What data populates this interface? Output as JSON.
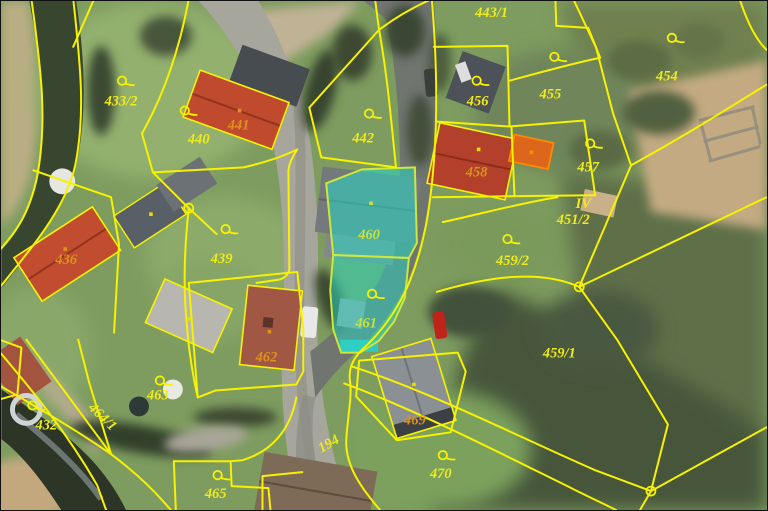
{
  "map": {
    "type": "cadastral-aerial-map",
    "highlighted_parcels": [
      "460",
      "461"
    ],
    "selected_building_parcel": "458-annex",
    "colors": {
      "parcel_line": "#f6f200",
      "land_label": "#f0eb1c",
      "building_label": "#dd921c",
      "highlight_label": "#c9e23a",
      "highlight_fill": "rgba(38,216,196,0.55)",
      "highlight_border": "#cfe63a",
      "selected_fill": "rgba(255,125,0,0.5)",
      "selected_border": "#ff8800"
    },
    "parcels": [
      {
        "number": "433/2",
        "kind": "land",
        "x": 120,
        "y": 100,
        "icon": {
          "x": 121,
          "y": 80
        }
      },
      {
        "number": "440",
        "kind": "land",
        "x": 198,
        "y": 138,
        "icon": {
          "x": 184,
          "y": 110
        }
      },
      {
        "number": "441",
        "kind": "building",
        "x": 238,
        "y": 124
      },
      {
        "number": "442",
        "kind": "land",
        "x": 363,
        "y": 137,
        "icon": {
          "x": 369,
          "y": 113
        }
      },
      {
        "number": "443/1",
        "kind": "land",
        "x": 492,
        "y": 11
      },
      {
        "number": "456",
        "kind": "land",
        "x": 478,
        "y": 100,
        "icon": {
          "x": 477,
          "y": 80
        }
      },
      {
        "number": "455",
        "kind": "land",
        "x": 551,
        "y": 93,
        "icon": {
          "x": 555,
          "y": 56
        }
      },
      {
        "number": "454",
        "kind": "land",
        "x": 668,
        "y": 75,
        "icon": {
          "x": 673,
          "y": 37
        }
      },
      {
        "number": "457",
        "kind": "land",
        "x": 589,
        "y": 166,
        "icon": {
          "x": 591,
          "y": 143
        }
      },
      {
        "number": "458",
        "kind": "building",
        "x": 477,
        "y": 171
      },
      {
        "number": "IV",
        "kind": "land",
        "x": 584,
        "y": 203
      },
      {
        "number": "451/2",
        "kind": "land",
        "x": 574,
        "y": 219
      },
      {
        "number": "459/2",
        "kind": "land",
        "x": 513,
        "y": 260,
        "icon": {
          "x": 508,
          "y": 239
        }
      },
      {
        "number": "459/1",
        "kind": "land",
        "x": 560,
        "y": 353
      },
      {
        "number": "436",
        "kind": "building",
        "x": 65,
        "y": 259
      },
      {
        "number": "439",
        "kind": "land",
        "x": 221,
        "y": 258,
        "icon": {
          "x": 225,
          "y": 229
        }
      },
      {
        "number": "460",
        "kind": "highlight",
        "x": 369,
        "y": 234
      },
      {
        "number": "461",
        "kind": "highlight",
        "x": 366,
        "y": 323,
        "icon": {
          "x": 372,
          "y": 294
        }
      },
      {
        "number": "462",
        "kind": "building",
        "x": 266,
        "y": 357
      },
      {
        "number": "432",
        "kind": "land",
        "x": 45,
        "y": 425,
        "icon": {
          "x": 31,
          "y": 406
        }
      },
      {
        "number": "464/1",
        "kind": "land",
        "x": 102,
        "y": 417,
        "rot": 44
      },
      {
        "number": "463",
        "kind": "land",
        "x": 157,
        "y": 395,
        "icon": {
          "x": 159,
          "y": 381
        }
      },
      {
        "number": "465",
        "kind": "land",
        "x": 215,
        "y": 494,
        "icon": {
          "x": 217,
          "y": 476
        }
      },
      {
        "number": "194",
        "kind": "land",
        "x": 328,
        "y": 444,
        "rot": -30
      },
      {
        "number": "469",
        "kind": "building",
        "x": 415,
        "y": 420
      },
      {
        "number": "470",
        "kind": "land",
        "x": 441,
        "y": 474,
        "icon": {
          "x": 443,
          "y": 456
        }
      }
    ],
    "building_dots": [
      {
        "x": 239,
        "y": 110,
        "color": "#dd921c"
      },
      {
        "x": 64,
        "y": 249,
        "color": "#dd921c"
      },
      {
        "x": 150,
        "y": 214,
        "color": "#e8e000"
      },
      {
        "x": 189,
        "y": 319,
        "color": "#e8e000"
      },
      {
        "x": 269,
        "y": 332,
        "color": "#dd921c"
      },
      {
        "x": 479,
        "y": 149,
        "color": "#e8e000"
      },
      {
        "x": 532,
        "y": 152,
        "color": "#ff8800"
      },
      {
        "x": 414,
        "y": 385,
        "color": "#e8e000"
      },
      {
        "x": 371,
        "y": 203,
        "color": "#c9e23a"
      }
    ],
    "vertex_nodes": [
      {
        "x": 188,
        "y": 208
      },
      {
        "x": 580,
        "y": 287
      },
      {
        "x": 652,
        "y": 492
      }
    ]
  }
}
